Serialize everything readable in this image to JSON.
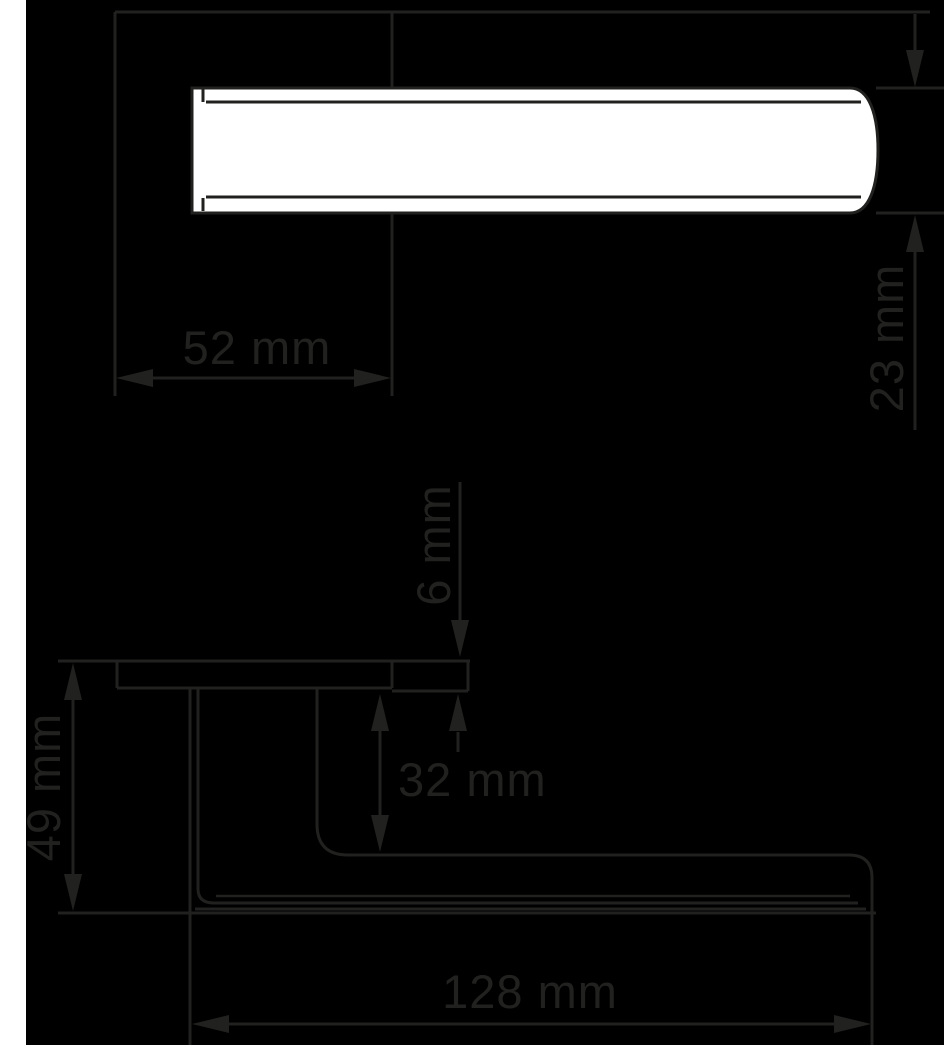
{
  "title": "Door handle dimension drawing",
  "colors": {
    "background": "#000000",
    "line": "#21211f",
    "shape_fill": "#ffffff"
  },
  "units": "mm",
  "top_view": {
    "dim_width": "52 mm",
    "dim_bar_thickness": "23 mm"
  },
  "side_view": {
    "dim_rose_thickness": "6 mm",
    "dim_neck_clearance": "32 mm",
    "dim_total_projection": "49 mm",
    "dim_lever_length": "128 mm"
  }
}
